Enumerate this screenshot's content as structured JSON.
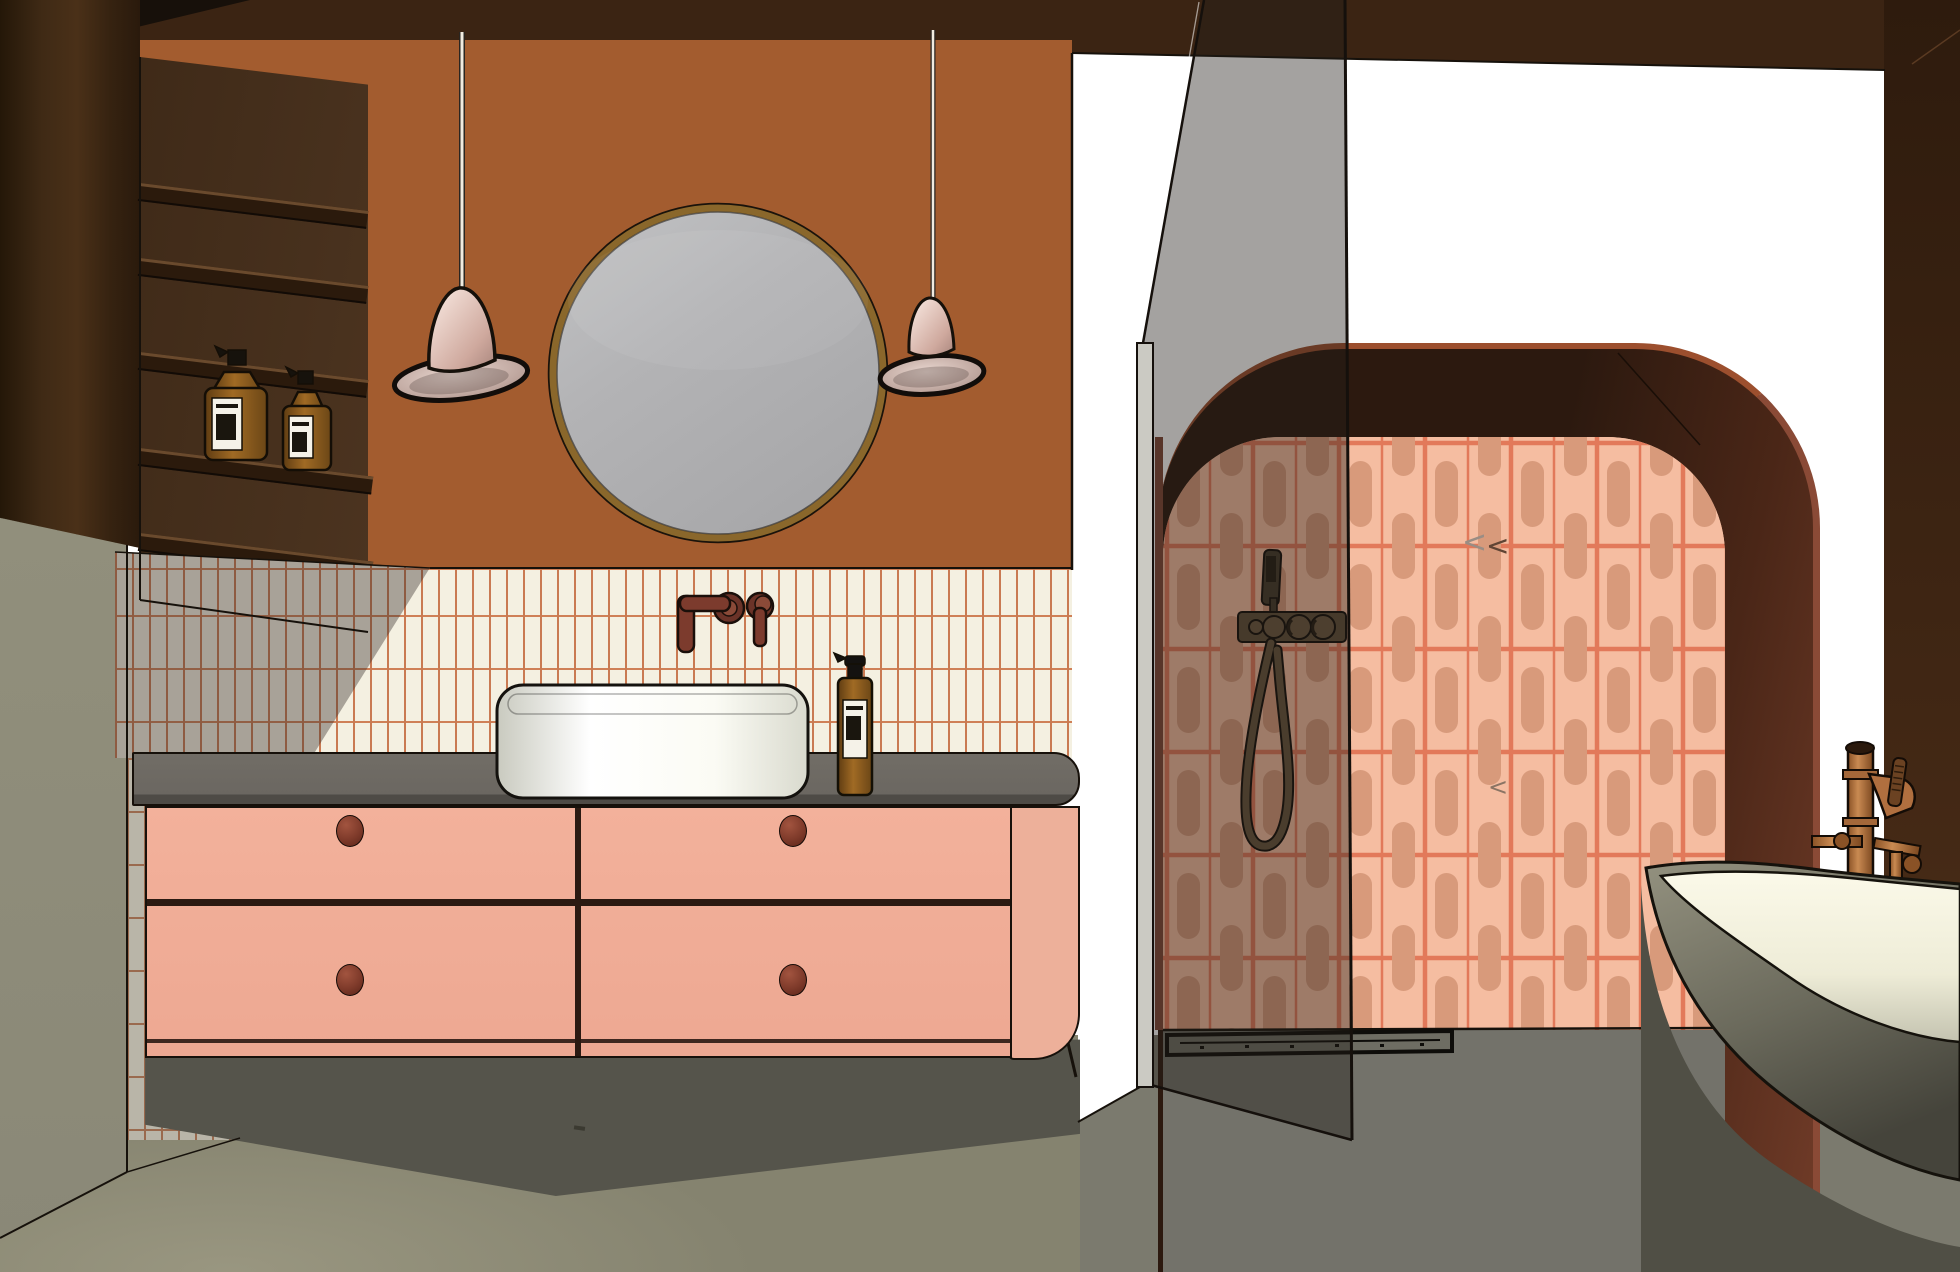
{
  "meta": {
    "title": "3D bathroom interior rendering (SketchUp-style line render)",
    "width_px": 1960,
    "height_px": 1272
  },
  "palette": {
    "wall_terracotta": "#a35c2f",
    "ceiling_brown": "#3b2413",
    "ceiling_corner_black": "#17100a",
    "niche_brown": "#46301d",
    "shelf_brown": "#2b1a0c",
    "wood_cabinet": "#3f2a15",
    "wall_sage": "#8e8c7b",
    "backsplash_tile": "#f4f0e1",
    "backsplash_grout": "#c97a52",
    "counter_gray": "#6b6761",
    "vanity_pink": "#f0ad97",
    "knob_brown": "#7e3a2a",
    "sink_white": "#fbfbf4",
    "faucet_oxblood": "#7c3b2d",
    "floor_gray": "#85836f",
    "floor_shower": "#73726a",
    "shadow_gray": "#55544b",
    "light_white": "#ffffff",
    "arch_band": "#3a1f12",
    "arch_rim": "#9c4f2e",
    "jamb_maroon": "#7e4636",
    "shower_tile_bg": "#f5bda1",
    "shower_tile_pill": "#d89a7b",
    "shower_tile_grout": "#e2795a",
    "right_wall_brown": "#382112",
    "glass_tint": "rgba(34,29,24,0.41)",
    "glass_clamp": "#cbcac3",
    "fixture_bronze": "#5f4e38",
    "tub_shell": "#8f8d7d",
    "tub_interior": "#f7f5e3",
    "tub_shadow": "#504f45",
    "copper": "#b06f3f",
    "pendant_pink": "#e9cfc5",
    "mirror_rim": "#8a672b",
    "mirror_glass": "#b3b3b5",
    "bottle_amber": "#8a5a22",
    "bottle_label": "#f5f2e8",
    "drain_black": "#0e0d0a"
  },
  "scene": {
    "objects": [
      "terracotta wall",
      "round mirror",
      "two pink pendant lamps",
      "dark wood shelving niche with amber soap bottles",
      "cream vertical stacked backsplash tile",
      "pink floating vanity with four drawers",
      "gray countertop",
      "white vessel sink",
      "wall mounted oxblood faucet",
      "amber soap dispenser",
      "walk-in shower with glass screen",
      "salmon capsule-pattern tile wall",
      "bronze hand shower and mixer",
      "linear floor drain",
      "arched opening with dark maroon surround",
      "freestanding gray tub",
      "copper floor standing bath filler",
      "speckled gray floor",
      "sage side wall"
    ]
  },
  "marks": {
    "chevron": "<",
    "chevron_faint": "<",
    "floor_dash": ""
  }
}
